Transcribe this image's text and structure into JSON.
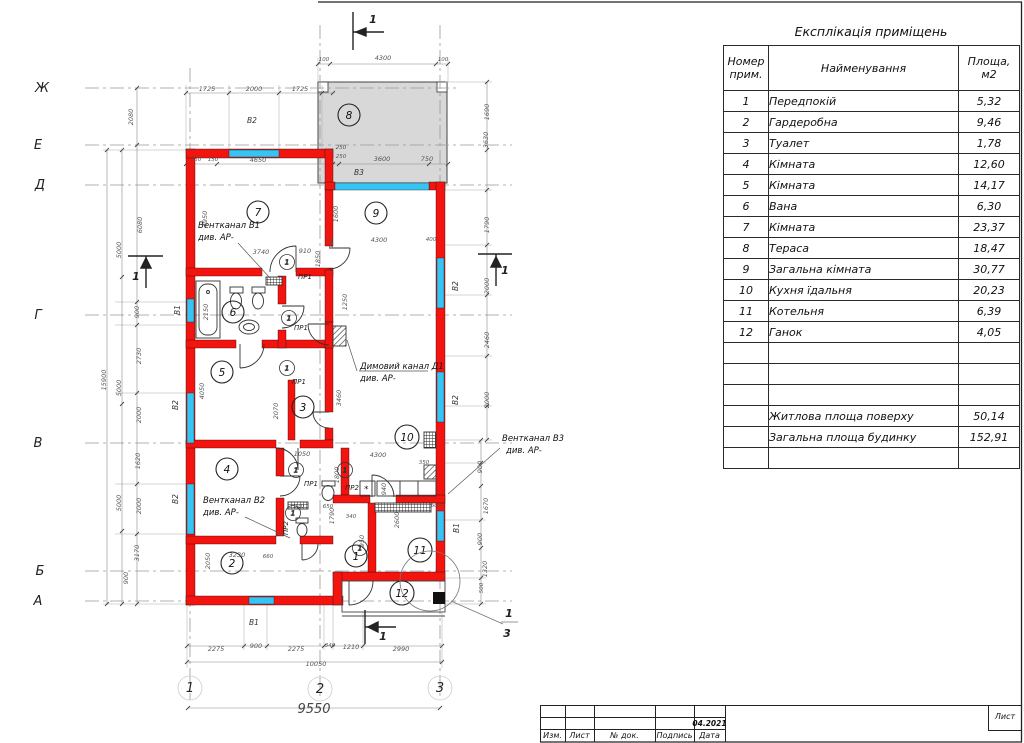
{
  "explication": {
    "title": "Експлікація приміщень",
    "headers": [
      "Номер прим.",
      "Найменування",
      "Площа, м2"
    ],
    "rows": [
      {
        "num": "1",
        "name": "Передпокій",
        "area": "5,32"
      },
      {
        "num": "2",
        "name": "Гардеробна",
        "area": "9,46"
      },
      {
        "num": "3",
        "name": "Туалет",
        "area": "1,78"
      },
      {
        "num": "4",
        "name": "Кімната",
        "area": "12,60"
      },
      {
        "num": "5",
        "name": "Кімната",
        "area": "14,17"
      },
      {
        "num": "6",
        "name": "Вана",
        "area": "6,30"
      },
      {
        "num": "7",
        "name": "Кімната",
        "area": "23,37"
      },
      {
        "num": "8",
        "name": "Тераса",
        "area": "18,47"
      },
      {
        "num": "9",
        "name": "Загальна кімната",
        "area": "30,77"
      },
      {
        "num": "10",
        "name": "Кухня їдальня",
        "area": "20,23"
      },
      {
        "num": "11",
        "name": "Котельня",
        "area": "6,39"
      },
      {
        "num": "12",
        "name": "Ганок",
        "area": "4,05"
      }
    ],
    "totals": [
      {
        "name": "Житлова площа поверху",
        "area": "50,14"
      },
      {
        "name": "Загальна площа будинку",
        "area": "152,91"
      }
    ]
  },
  "title_block": {
    "labels": [
      "Изм.",
      "Лист",
      "№ док.",
      "Подпись",
      "Дата"
    ],
    "date": "04.2021",
    "sheet_label": "Лист"
  },
  "plan": {
    "axes_letters": [
      "Ж",
      "Е",
      "Д",
      "Г",
      "В",
      "Б",
      "А"
    ],
    "axes_numbers": [
      "1",
      "2",
      "3"
    ],
    "rooms": [
      "1",
      "2",
      "3",
      "4",
      "5",
      "6",
      "7",
      "8",
      "9",
      "10",
      "11",
      "12"
    ],
    "door_circle": "1",
    "section_mark": "1",
    "detail_top": "1",
    "detail_bottom": "3",
    "annotations": [
      "Вентканал В1",
      "див. АР-",
      "Димовий канал Д1",
      "див. АР-",
      "Вентканал В2",
      "див. АР-",
      "Вентканал В3",
      "див. АР-"
    ],
    "window_labels": [
      "В2",
      "В3",
      "В1",
      "В2",
      "В2",
      "В2",
      "В2",
      "В1",
      "В1"
    ],
    "door_labels": [
      "ПР1",
      "ПР1",
      "ПР1",
      "ПР1",
      "ПР2",
      "ПР2"
    ],
    "dims": [
      "1725",
      "2000",
      "1725",
      "100",
      "4300",
      "100",
      "250",
      "150",
      "4650",
      "250",
      "250",
      "3600",
      "750",
      "2080",
      "6080",
      "900",
      "2730",
      "2000",
      "1620",
      "2000",
      "3170",
      "900",
      "5000",
      "5000",
      "5000",
      "15900",
      "1690",
      "3630",
      "1790",
      "2000",
      "2460",
      "2000",
      "900",
      "1670",
      "900",
      "1320",
      "500",
      "2275",
      "900",
      "2275",
      "340",
      "1210",
      "2990",
      "10050",
      "9550",
      "4950",
      "3740",
      "910",
      "1850",
      "1600",
      "4300",
      "400",
      "2150",
      "4050",
      "2070",
      "1250",
      "3460",
      "1050",
      "4300",
      "1800",
      "1790",
      "950",
      "2600",
      "940",
      "600",
      "340",
      "910",
      "650",
      "660",
      "3230",
      "2050",
      "350",
      "100"
    ],
    "colors": {
      "wall": "#f3140f",
      "window": "#35c5f4",
      "terrace": "#d8d8d8"
    }
  }
}
